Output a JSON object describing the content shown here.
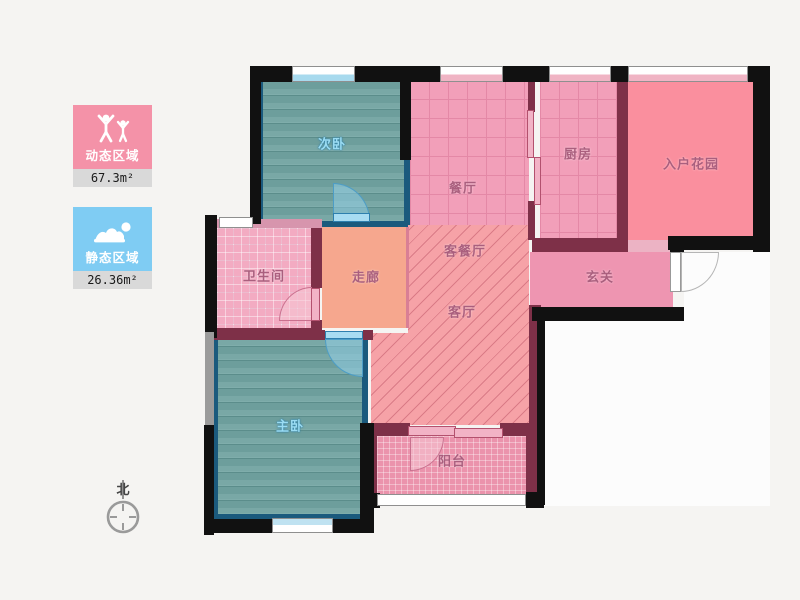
{
  "page": {
    "background": "#f5f4f2"
  },
  "legend": {
    "dynamic": {
      "label": "动态区域",
      "area": "67.3m²",
      "color": "#f492a8",
      "icon": "people-arms-up-icon"
    },
    "static": {
      "label": "静态区域",
      "area": "26.36m²",
      "color": "#7fccf3",
      "icon": "person-lying-icon"
    }
  },
  "compass": {
    "north_label": "北"
  },
  "rooms": {
    "second_bedroom": "次卧",
    "dining": "餐厅",
    "kitchen": "厨房",
    "entry_garden": "入户花园",
    "bathroom": "卫生间",
    "corridor": "走廊",
    "living_dining": "客餐厅",
    "living": "客厅",
    "hallway": "玄关",
    "master_bedroom": "主卧",
    "balcony": "阳台"
  },
  "palette": {
    "wall_black": "#111111",
    "wall_maroon": "#7e3048",
    "bedroom_floor": "#73a4a2",
    "bedroom_border": "#1b5a7d",
    "dining_kitchen_floor": "#f29fb9",
    "entry_garden_floor": "#fa8f9e",
    "hallway_floor": "#ee95b1",
    "corridor_floor": "#f6a78e",
    "living_floor": "#f6a2a7",
    "bathroom_floor": "#f3abc2",
    "balcony_floor": "#eb93ac"
  }
}
